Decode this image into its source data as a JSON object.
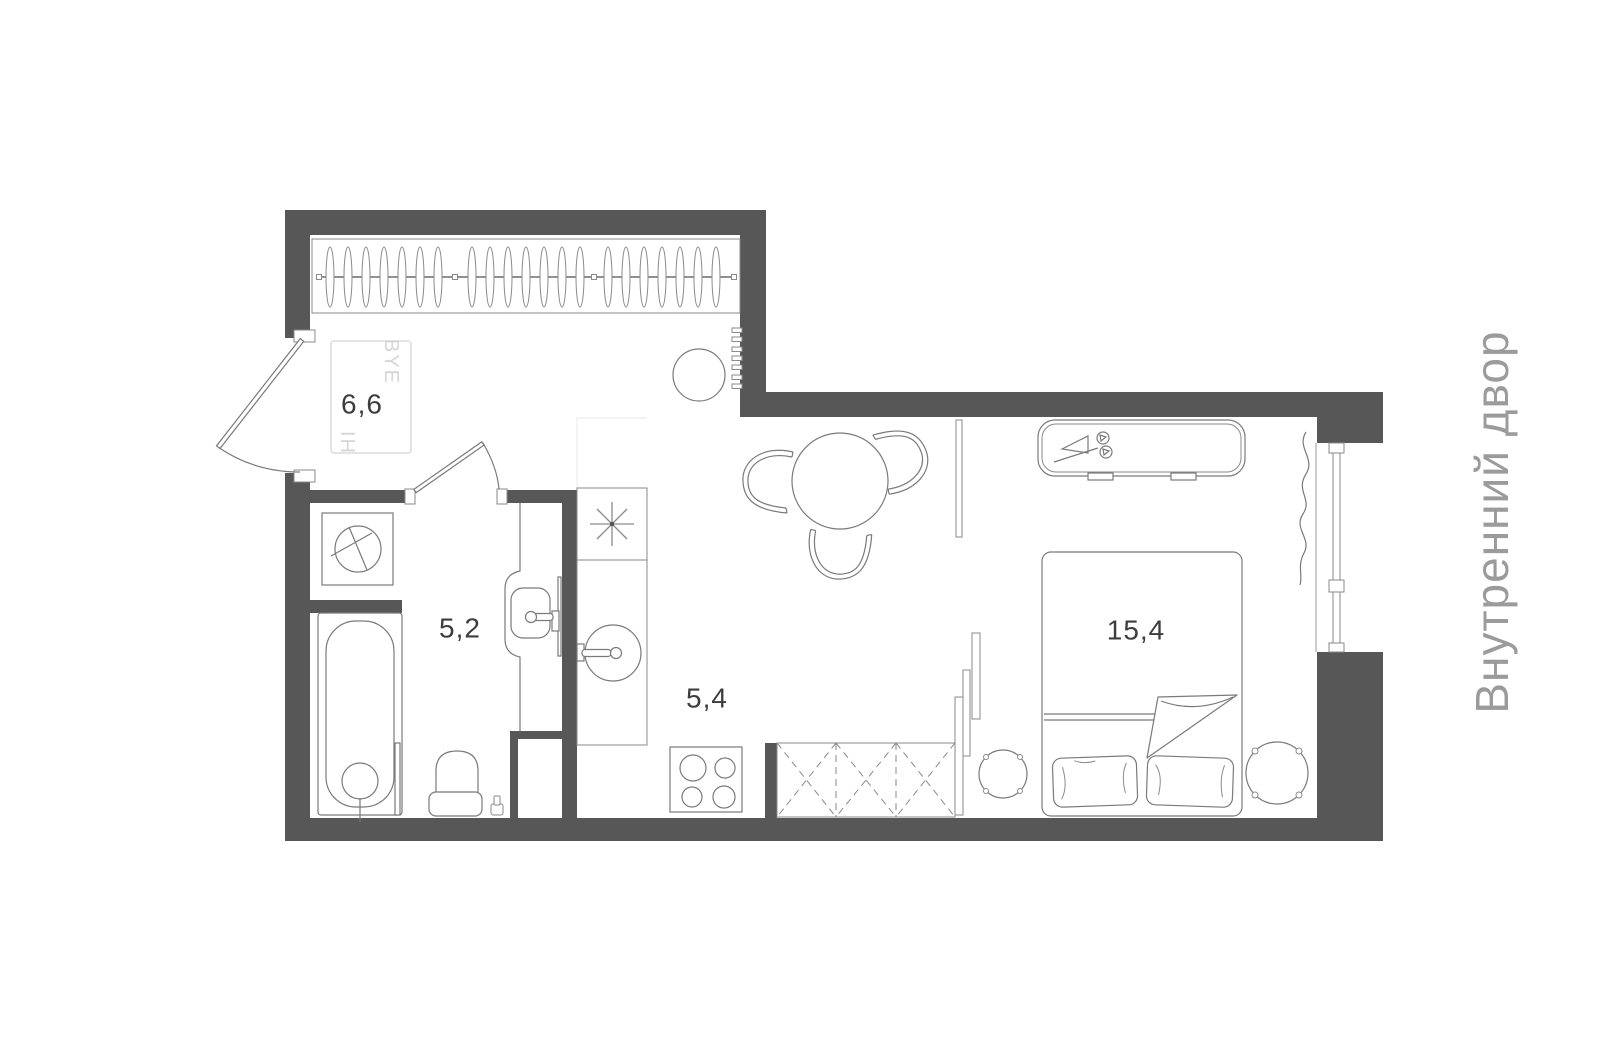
{
  "floor_plan": {
    "rooms": [
      {
        "name": "hallway",
        "area": "6,6"
      },
      {
        "name": "bathroom",
        "area": "5,2"
      },
      {
        "name": "kitchen",
        "area": "5,4"
      },
      {
        "name": "bedroom-living",
        "area": "15,4"
      }
    ],
    "doormat": {
      "text_top": "BYE",
      "text_bottom": "HI"
    },
    "exterior_label": "Внутренний двор",
    "colors": {
      "wall": "#575757",
      "furniture_line": "#7a7a7a",
      "room_label": "#3d3d3d",
      "exterior_label": "#9b9b9b",
      "doormat_text": "#d5d5d5"
    }
  }
}
